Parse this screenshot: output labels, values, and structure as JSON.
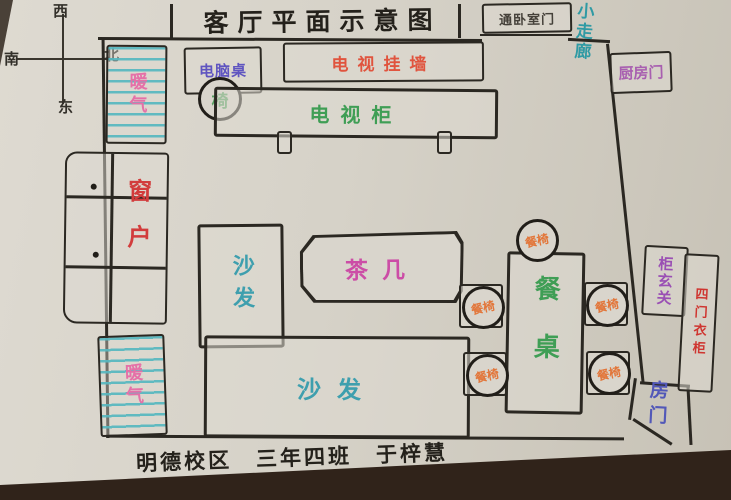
{
  "title": "客厅平面示意图",
  "footer": "明德校区　三年四班　于梓慧",
  "compass": {
    "top": "西",
    "left": "南",
    "right": "北",
    "bottom": "东"
  },
  "labels": {
    "bedroom_door": "通卧室门",
    "corridor": "小走廊",
    "kitchen_door": "厨房门",
    "computer_desk": "电脑桌",
    "chair": "椅",
    "tv_wall": "电视挂墙",
    "tv_cabinet": "电视柜",
    "radiator_top": "暖气",
    "radiator_bottom": "暖气",
    "window": "窗户",
    "sofa_left": "沙发",
    "sofa_bottom": "沙发",
    "tea_table": "茶几",
    "dining_table": "餐桌",
    "dining_chair": "餐椅",
    "entry_cabinet": "柜玄关",
    "wardrobe": "四门衣柜",
    "room_door": "房门"
  },
  "colors": {
    "ink": "#2b2822",
    "paper": "#d6d2c8",
    "teal": "#3e9fae",
    "stripe_teal": "#5ab8c0",
    "green": "#3f9e55",
    "red_orange": "#e0543e",
    "red": "#d23c3c",
    "magenta": "#cc4da6",
    "orange": "#e2763a",
    "pink": "#e570a8",
    "purple_blue": "#5f55c0",
    "purple": "#9a4fb4",
    "dark_red": "#cf3530",
    "table_brown": "#30231a"
  }
}
